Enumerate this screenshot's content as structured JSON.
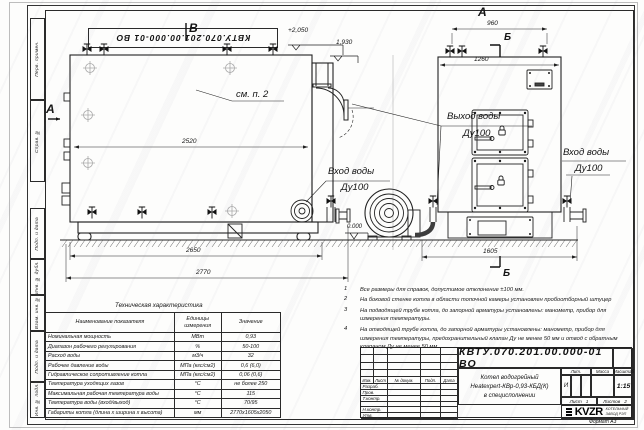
{
  "stamp": {
    "doc_number": "КВТУ.070.201.00.000-01  ВО"
  },
  "margin_labels": [
    "Перв. примен.",
    "Справ. №",
    "Подп. и дата",
    "Инв. № дубл.",
    "Взам. инв. №",
    "Подп. и дата",
    "Инв. № подл."
  ],
  "drawing": {
    "view_b": "В",
    "view_a_top": "А",
    "view_a_side": "А",
    "section_b_top": "Б",
    "section_b_bottom": "Б",
    "see_item": "см. п. 2",
    "elev_top": "+2,050",
    "elev_mid": "1,930",
    "elev_zero": "0.000",
    "outlet_label": "Выход воды",
    "outlet_dn": "Ду100",
    "inlet_side_label": "Вход воды",
    "inlet_side_dn": "Ду100",
    "inlet_front_label": "Вход воды",
    "inlet_front_dn": "Ду100",
    "dim_2520": "2520",
    "dim_2650": "2650",
    "dim_2770": "2770",
    "dim_960": "960",
    "dim_1260": "1260",
    "dim_1605": "1605"
  },
  "tech_table": {
    "title": "Техническая характеристика",
    "headers": [
      "Наименование показателя",
      "Единицы измерения",
      "Значение"
    ],
    "rows": [
      [
        "Номинальная мощность",
        "МВт",
        "0,93"
      ],
      [
        "Диапазон рабочего регулирования",
        "%",
        "50-100"
      ],
      [
        "Расход воды",
        "м3/ч",
        "32"
      ],
      [
        "Рабочее давление воды",
        "МПа (кгс/см2)",
        "0,6 (6,0)"
      ],
      [
        "Гидравлическое сопротивление котла",
        "МПа (кгс/см2)",
        "0,06 (0,6)"
      ],
      [
        "Температура уходящих газов",
        "°С",
        "не более 250"
      ],
      [
        "Максимальная рабочая температура воды",
        "°С",
        "115"
      ],
      [
        "Температура воды (вход/выход)",
        "°С",
        "70/95"
      ],
      [
        "Габариты котла (длина х ширина х высота)",
        "мм",
        "2770х1605х2050"
      ]
    ]
  },
  "notes": [
    {
      "n": "1",
      "text": "Все размеры для справок, допустимое отклонение  ±100 мм."
    },
    {
      "n": "2",
      "text": "На боковой стенке котла в области топочной камеры установлен пробоотборный штуцер"
    },
    {
      "n": "3",
      "text": "На  подводящей трубе котла, до запорной арматуры установлены: манометр, прибор для измерения температуры."
    },
    {
      "n": "4",
      "text": "На отводящей трубе котла, до запорной арматуры установлены: манометр, прибор для измерения температуры, предохранительный клапан Ду не менее 50 мм и отвод с обратным клапаном Ду не менее 50 мм."
    }
  ],
  "title_block": {
    "doc_number": "КВТУ.070.201.00.000-01  ВО",
    "product_lines": [
      "Котел водогрейный",
      "Heatexpert-КВр-0,93-КБД(К)",
      "в специсполнении"
    ],
    "change_cols": [
      "Изм.",
      "Лист",
      "№ докум.",
      "Подп.",
      "Дата"
    ],
    "sign_rows": [
      "Разраб.",
      "Пров.",
      "Т.контр.",
      "",
      "Н.контр.",
      "Утв."
    ],
    "lit_label": "Лит.",
    "lit_value": "И",
    "mass_label": "Масса",
    "scale_label": "Масштаб",
    "scale_value": "1:15",
    "sheet_label": "Лист",
    "sheet_value": "1",
    "sheets_label": "Листов",
    "sheets_value": "2",
    "logo_text": "KVZR",
    "company_lines": [
      "КОТЕЛЬНЫЙ",
      "ЗАВОД РЭП"
    ],
    "format_note": "Формат  А3"
  }
}
